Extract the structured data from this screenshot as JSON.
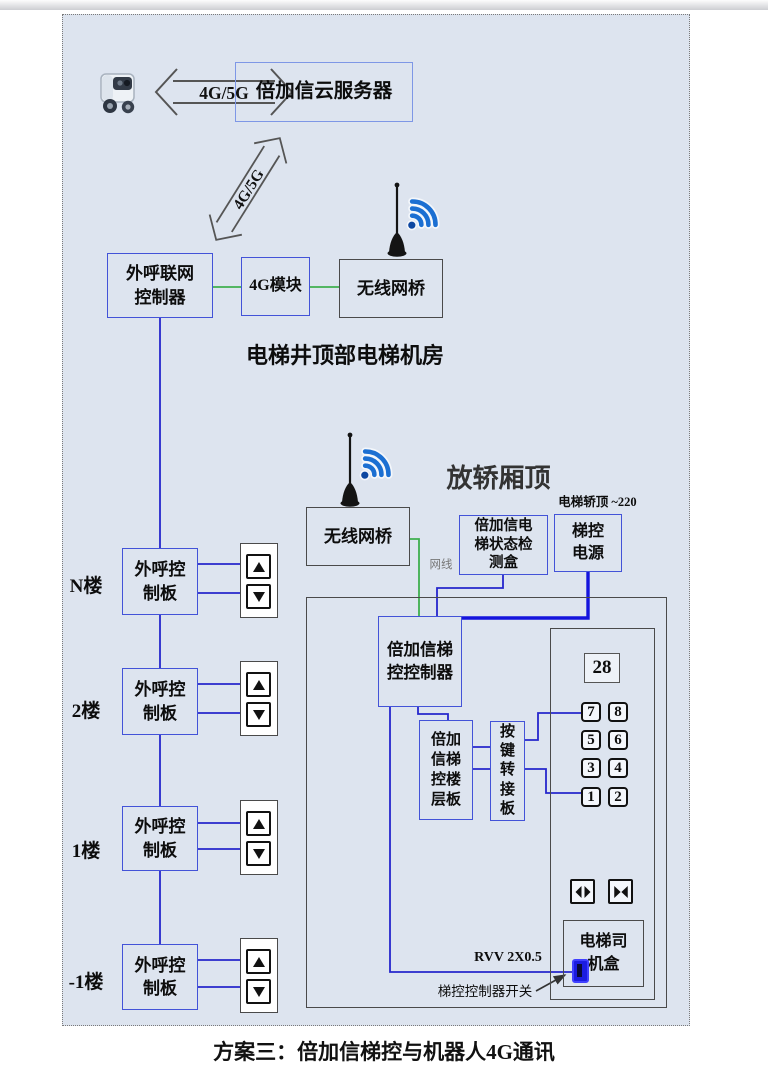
{
  "colors": {
    "canvas_bg": "#dde4ef",
    "blue_box_border": "#4353d8",
    "cloud_box_border": "#7e97e6",
    "gray_box_border": "#4a4a4a",
    "wire_blue": "#2626cc",
    "wire_green": "#3faf4f",
    "power_wire_blue": "#1414dd",
    "wifi_blue": "#1b6fd2",
    "switch_blue": "#1c1ce0"
  },
  "top": {
    "robot_icon": "robot-icon",
    "arrow_label": "4G/5G",
    "cloud_server_label": "倍加信云服务器",
    "diagonal_arrow_label": "4G/5G"
  },
  "machine_room": {
    "gateway_label": "外呼联网控制器",
    "module_label": "4G模块",
    "bridge_label": "无线网桥",
    "caption": "电梯井顶部电梯机房"
  },
  "car_top": {
    "caption": "放轿厢顶",
    "bridge_label": "无线网桥",
    "cable_label": "网线",
    "status_box_label": "倍加信电梯状态检测盒",
    "power_note": "电梯轿顶 ~220",
    "power_label": "梯控电源"
  },
  "labels": {
    "call_board": "外呼控制板"
  },
  "floors": [
    {
      "label": "N楼"
    },
    {
      "label": "2楼"
    },
    {
      "label": "1楼"
    },
    {
      "label": "-1楼"
    }
  ],
  "car": {
    "controller_label": "倍加信梯控控制器",
    "floor_board_label": "倍加信梯控楼层板",
    "key_adapter_label": "按键转接板",
    "display_value": "28",
    "buttons": [
      "7",
      "8",
      "5",
      "6",
      "3",
      "4",
      "1",
      "2"
    ],
    "driver_box_label": "电梯司机盒",
    "rvv_label": "RVV 2X0.5",
    "switch_label": "梯控控制器开关"
  },
  "caption": "方案三：倍加信梯控与机器人4G通讯"
}
